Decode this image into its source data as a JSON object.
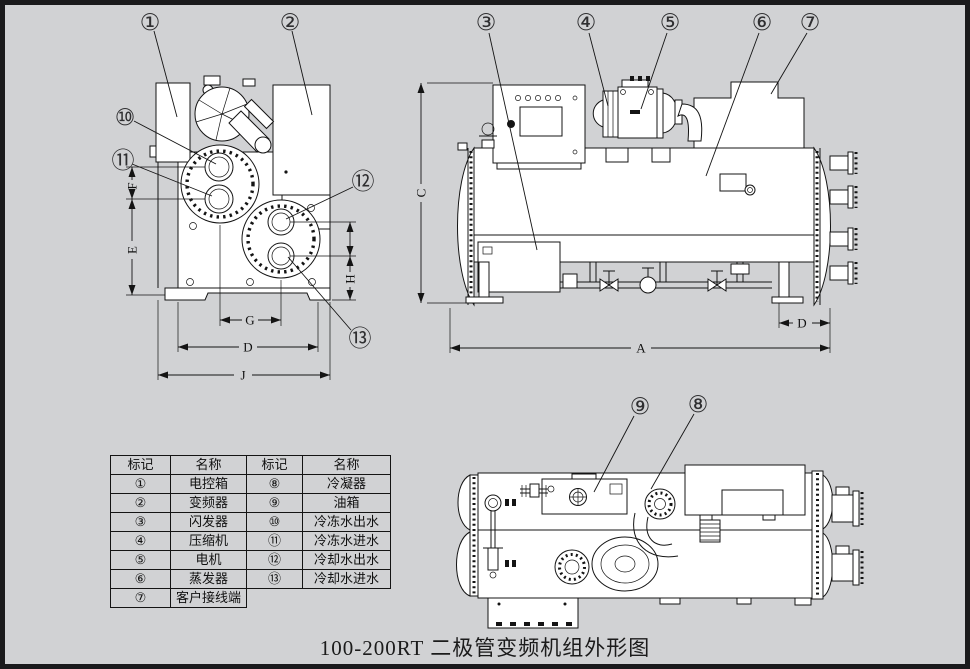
{
  "window": {
    "background": "#d1d2d4",
    "frame_color": "#1a1a1c",
    "line_color": "#141414"
  },
  "caption": "100-200RT 二极管变频机组外形图",
  "callouts": {
    "c1": "①",
    "c2": "②",
    "c3": "③",
    "c4": "④",
    "c5": "⑤",
    "c6": "⑥",
    "c7": "⑦",
    "c8": "⑧",
    "c9": "⑨",
    "c10": "⑩",
    "c11": "⑪",
    "c12": "⑫",
    "c13": "⑬"
  },
  "dims": {
    "a": "A",
    "c": "C",
    "d_side": "D",
    "d_front": "D",
    "e": "E",
    "f": "F",
    "g": "G",
    "h": "H",
    "j": "J"
  },
  "parts_table": {
    "headers": [
      "标记",
      "名称",
      "标记",
      "名称"
    ],
    "rows": [
      [
        "①",
        "电控箱",
        "⑧",
        "冷凝器"
      ],
      [
        "②",
        "变频器",
        "⑨",
        "油箱"
      ],
      [
        "③",
        "闪发器",
        "⑩",
        "冷冻水出水"
      ],
      [
        "④",
        "压缩机",
        "⑪",
        "冷冻水进水"
      ],
      [
        "⑤",
        "电机",
        "⑫",
        "冷却水出水"
      ],
      [
        "⑥",
        "蒸发器",
        "⑬",
        "冷却水进水"
      ],
      [
        "⑦",
        "客户接线端",
        "",
        ""
      ]
    ]
  }
}
